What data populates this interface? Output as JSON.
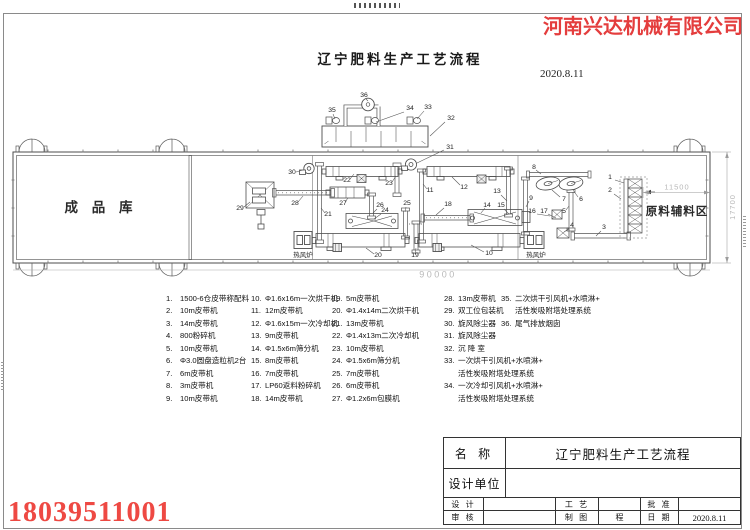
{
  "header": {
    "company": "河南兴达机械有限公司",
    "title": "辽宁肥料生产工艺流程",
    "date": "2020.8.11"
  },
  "phone": "18039511001",
  "drawing": {
    "rooms": {
      "finished_warehouse": "成 品 库",
      "raw_material_area": "原料辅料区"
    },
    "furnace_label": "热风炉",
    "dimensions": {
      "total_length": "90000",
      "raw_area_width": "11500",
      "building_depth": "17700"
    },
    "labels": [
      {
        "n": "1",
        "tx": 610,
        "ty": 179,
        "x1": 615,
        "y1": 180,
        "x2": 624,
        "y2": 183
      },
      {
        "n": "2",
        "tx": 610,
        "ty": 192,
        "x1": 614,
        "y1": 194,
        "x2": 621,
        "y2": 199
      },
      {
        "n": "3",
        "tx": 604,
        "ty": 229,
        "x1": 601,
        "y1": 231,
        "x2": 596,
        "y2": 236
      },
      {
        "n": "4",
        "tx": 572,
        "ty": 227,
        "x1": 569,
        "y1": 229,
        "x2": 564,
        "y2": 232
      },
      {
        "n": "5",
        "tx": 564,
        "ty": 213,
        "x1": 566,
        "y1": 210,
        "x2": 569,
        "y2": 206
      },
      {
        "n": "6",
        "tx": 581,
        "ty": 201,
        "x1": 578,
        "y1": 197,
        "x2": 573,
        "y2": 190
      },
      {
        "n": "7",
        "tx": 564,
        "ty": 201,
        "x1": 560,
        "y1": 197,
        "x2": 552,
        "y2": 190
      },
      {
        "n": "8",
        "tx": 534,
        "ty": 169,
        "x1": 536,
        "y1": 170,
        "x2": 541,
        "y2": 174
      },
      {
        "n": "9",
        "tx": 531,
        "ty": 200,
        "x1": 529,
        "y1": 201,
        "x2": 526,
        "y2": 207
      },
      {
        "n": "10",
        "tx": 489,
        "ty": 255,
        "x1": 484,
        "y1": 252,
        "x2": 471,
        "y2": 245
      },
      {
        "n": "11",
        "tx": 430,
        "ty": 192,
        "x1": 427,
        "y1": 189,
        "x2": 423,
        "y2": 184
      },
      {
        "n": "12",
        "tx": 464,
        "ty": 189,
        "x1": 460,
        "y1": 185,
        "x2": 452,
        "y2": 177
      },
      {
        "n": "13",
        "tx": 497,
        "ty": 193,
        "x1": 501,
        "y1": 195,
        "x2": 507,
        "y2": 201
      },
      {
        "n": "14",
        "tx": 487,
        "ty": 207,
        "x1": 485,
        "y1": 208,
        "x2": 481,
        "y2": 213
      },
      {
        "n": "15",
        "tx": 501,
        "ty": 207,
        "x1": 504,
        "y1": 209,
        "x2": 509,
        "y2": 214
      },
      {
        "n": "16",
        "tx": 532,
        "ty": 213,
        "x1": 537,
        "y1": 214,
        "x2": 550,
        "y2": 216
      },
      {
        "n": "17",
        "tx": 544,
        "ty": 213,
        "x1": 548,
        "y1": 214,
        "x2": 556,
        "y2": 218
      },
      {
        "n": "18",
        "tx": 448,
        "ty": 206,
        "x1": 444,
        "y1": 208,
        "x2": 436,
        "y2": 215
      },
      {
        "n": "19",
        "tx": 415,
        "ty": 257,
        "x1": 415,
        "y1": 254,
        "x2": 416,
        "y2": 248
      },
      {
        "n": "20",
        "tx": 378,
        "ty": 257,
        "x1": 374,
        "y1": 254,
        "x2": 366,
        "y2": 248
      },
      {
        "n": "21",
        "tx": 328,
        "ty": 216,
        "x1": 325,
        "y1": 213,
        "x2": 321,
        "y2": 208
      },
      {
        "n": "22",
        "tx": 347,
        "ty": 182,
        "x1": 350,
        "y1": 179,
        "x2": 354,
        "y2": 174
      },
      {
        "n": "23",
        "tx": 389,
        "ty": 185,
        "x1": 392,
        "y1": 182,
        "x2": 396,
        "y2": 176
      },
      {
        "n": "24",
        "tx": 385,
        "ty": 212,
        "x1": 381,
        "y1": 214,
        "x2": 374,
        "y2": 219
      },
      {
        "n": "25",
        "tx": 407,
        "ty": 205,
        "x1": 406,
        "y1": 207,
        "x2": 405,
        "y2": 212
      },
      {
        "n": "26",
        "tx": 380,
        "ty": 207,
        "x1": 377,
        "y1": 209,
        "x2": 373,
        "y2": 213
      },
      {
        "n": "27",
        "tx": 343,
        "ty": 205,
        "x1": 345,
        "y1": 202,
        "x2": 348,
        "y2": 198
      },
      {
        "n": "28",
        "tx": 295,
        "ty": 205,
        "x1": 298,
        "y1": 202,
        "x2": 303,
        "y2": 196
      },
      {
        "n": "29",
        "tx": 240,
        "ty": 210,
        "x1": 244,
        "y1": 207,
        "x2": 250,
        "y2": 202
      },
      {
        "n": "30",
        "tx": 292,
        "ty": 174,
        "x1": 296,
        "y1": 172,
        "x2": 303,
        "y2": 170
      },
      {
        "n": "31",
        "tx": 450,
        "ty": 149,
        "x1": 444,
        "y1": 150,
        "x2": 417,
        "y2": 163
      },
      {
        "n": "32",
        "tx": 451,
        "ty": 120,
        "x1": 445,
        "y1": 122,
        "x2": 430,
        "y2": 136
      },
      {
        "n": "33",
        "tx": 428,
        "ty": 109,
        "x1": 424,
        "y1": 111,
        "x2": 417,
        "y2": 119
      },
      {
        "n": "34",
        "tx": 410,
        "ty": 110,
        "x1": 404,
        "y1": 112,
        "x2": 376,
        "y2": 122
      },
      {
        "n": "35",
        "tx": 332,
        "ty": 112,
        "x1": 333,
        "y1": 114,
        "x2": 335,
        "y2": 119
      },
      {
        "n": "36",
        "tx": 364,
        "ty": 97,
        "x1": 366,
        "y1": 99,
        "x2": 368,
        "y2": 101
      }
    ]
  },
  "legend": {
    "columns": [
      {
        "x": 166,
        "items": [
          {
            "no": "1.",
            "lines": [
              "1500-6仓皮带称配料"
            ]
          },
          {
            "no": "2.",
            "lines": [
              "10m皮带机"
            ]
          },
          {
            "no": "3.",
            "lines": [
              "14m皮带机"
            ]
          },
          {
            "no": "4.",
            "lines": [
              "800粉碎机"
            ]
          },
          {
            "no": "5.",
            "lines": [
              "10m皮带机"
            ]
          },
          {
            "no": "6.",
            "lines": [
              "Φ3.0圆盘造粒机2台"
            ]
          },
          {
            "no": "7.",
            "lines": [
              "6m皮带机"
            ]
          },
          {
            "no": "8.",
            "lines": [
              "3m皮带机"
            ]
          },
          {
            "no": "9.",
            "lines": [
              "10m皮带机"
            ]
          }
        ]
      },
      {
        "x": 251,
        "items": [
          {
            "no": "10.",
            "lines": [
              "Φ1.6x16m一次烘干机"
            ]
          },
          {
            "no": "11.",
            "lines": [
              "12m皮带机"
            ]
          },
          {
            "no": "12.",
            "lines": [
              "Φ1.6x15m一次冷却机"
            ]
          },
          {
            "no": "13.",
            "lines": [
              "9m皮带机"
            ]
          },
          {
            "no": "14.",
            "lines": [
              "Φ1.5x6m筛分机"
            ]
          },
          {
            "no": "15.",
            "lines": [
              "8m皮带机"
            ]
          },
          {
            "no": "16.",
            "lines": [
              "7m皮带机"
            ]
          },
          {
            "no": "17.",
            "lines": [
              "LP60返料粉碎机"
            ]
          },
          {
            "no": "18.",
            "lines": [
              "14m皮带机"
            ]
          }
        ]
      },
      {
        "x": 332,
        "items": [
          {
            "no": "19.",
            "lines": [
              "5m皮带机"
            ]
          },
          {
            "no": "20.",
            "lines": [
              "Φ1.4x14m二次烘干机"
            ]
          },
          {
            "no": "21.",
            "lines": [
              "13m皮带机"
            ]
          },
          {
            "no": "22.",
            "lines": [
              "Φ1.4x13m二次冷却机"
            ]
          },
          {
            "no": "23.",
            "lines": [
              "10m皮带机"
            ]
          },
          {
            "no": "24.",
            "lines": [
              "Φ1.5x6m筛分机"
            ]
          },
          {
            "no": "25.",
            "lines": [
              "7m皮带机"
            ]
          },
          {
            "no": "26.",
            "lines": [
              "6m皮带机"
            ]
          },
          {
            "no": "27.",
            "lines": [
              "Φ1.2x6m包膜机"
            ]
          }
        ]
      },
      {
        "x": 444,
        "items": [
          {
            "no": "28.",
            "lines": [
              "13m皮带机"
            ]
          },
          {
            "no": "29.",
            "lines": [
              "双工位包装机"
            ]
          },
          {
            "no": "30.",
            "lines": [
              "旋风除尘器"
            ]
          },
          {
            "no": "31.",
            "lines": [
              "旋风除尘器"
            ]
          },
          {
            "no": "32.",
            "lines": [
              "沉 降 室"
            ]
          },
          {
            "no": "33.",
            "lines": [
              "一次烘干引风机+水喷淋+",
              "活性炭吸附塔处理系统"
            ]
          },
          {
            "no": "34.",
            "lines": [
              "一次冷却引风机+水喷淋+",
              "活性炭吸附塔处理系统"
            ]
          }
        ]
      },
      {
        "x": 501,
        "items": [
          {
            "no": "35.",
            "lines": [
              "二次烘干引风机+水喷淋+",
              "活性炭吸附塔处理系统"
            ]
          },
          {
            "no": "36.",
            "lines": [
              "尾气排放烟囱"
            ]
          }
        ]
      }
    ]
  },
  "title_block": {
    "name_label": "名 称",
    "name_value": "辽宁肥料生产工艺流程",
    "design_unit_label": "设计单位",
    "design_unit_value": "",
    "rows": [
      {
        "c1": "设 计",
        "c2": "",
        "c3": "工 艺",
        "c4": "",
        "c5": "批 准",
        "c6": ""
      },
      {
        "c1": "审 核",
        "c2": "",
        "c3": "制 图",
        "c4": "程",
        "c5": "日 期",
        "c6": "2020.8.11"
      }
    ]
  }
}
